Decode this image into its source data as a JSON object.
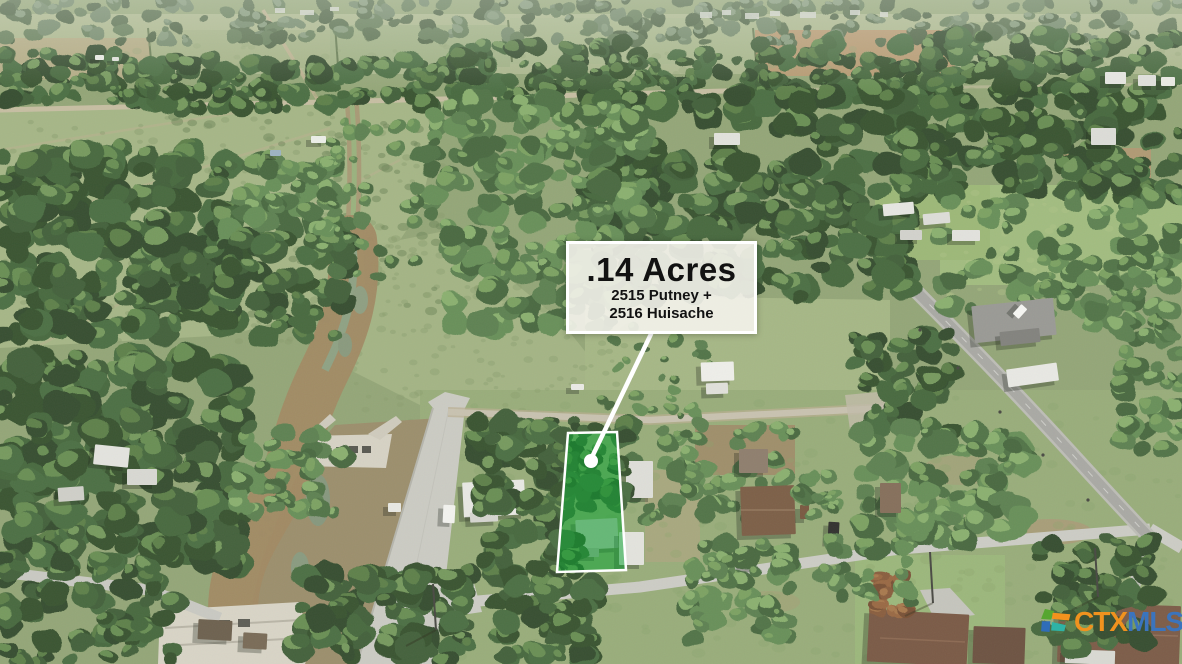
{
  "listing": {
    "acreage": ".14 Acres",
    "address_line_1": "2515 Putney +",
    "address_line_2": "2516 Huisache"
  },
  "overlay": {
    "parcel_fill": "#0aa32f",
    "parcel_border": "#ffffff",
    "marker_color": "#ffffff",
    "leader_color": "#ffffff"
  },
  "brand": {
    "prefix": "CTX",
    "suffix": "MLS",
    "prefix_color": "#f0921e",
    "suffix_color": "#3b74bd",
    "icon_green": "#56a630",
    "icon_orange": "#f2921d",
    "icon_blue": "#2f6db8",
    "icon_teal": "#2fb3a6"
  }
}
